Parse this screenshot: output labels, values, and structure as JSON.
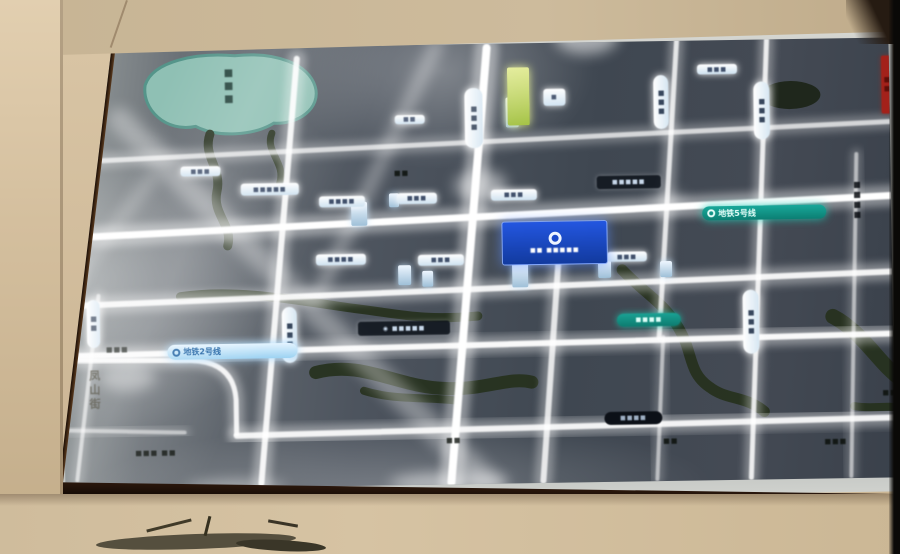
{
  "texts": {
    "metro_line_2": "地铁2号线",
    "metro_line_5": "地铁5号线",
    "street_vertical": "凤山街",
    "lake_label": "■■■",
    "project_logo_text": "■■ ■■■■■"
  },
  "colors": {
    "wall": "#cbb694",
    "frame": "#4a2d15",
    "map_bg": "#454c56",
    "road": "#ffffff",
    "lake": "#8fc0b4",
    "lake_edge": "#55958a",
    "river": "#26311d",
    "trees": "#1c2316",
    "metro2": "#9cd2f2",
    "metro5": "#12998c",
    "project_blue": "#1b49c8",
    "red_marker": "#a3211a"
  },
  "map": {
    "lake_path": "M 86,36 C 94,12 138,4 176,8 C 218,4 250,18 256,40 C 262,62 238,78 214,76 C 194,88 158,90 136,78 C 106,84 82,60 86,36 Z",
    "rivers": [
      {
        "d": "M 150,86 C 142,108 162,120 156,144 C 151,166 172,178 166,198",
        "w": 9
      },
      {
        "d": "M 212,86 C 204,104 226,116 219,136",
        "w": 7
      },
      {
        "d": "M 118,248 C 180,240 245,256 295,263 C 338,269 360,276 415,272",
        "w": 9
      },
      {
        "d": "M 252,326 C 300,314 332,342 382,344 C 424,346 444,333 468,339",
        "w": 13
      },
      {
        "d": "M 300,345 C 330,355 360,352 390,356",
        "w": 8
      },
      {
        "d": "M 560,228 C 582,252 602,262 616,288 C 630,312 624,332 646,347 C 662,360 682,356 700,372",
        "w": 11
      },
      {
        "d": "M 770,278 C 800,294 818,330 838,342",
        "w": 15
      },
      {
        "d": "M 790,368 C 810,372 826,366 838,372",
        "w": 8
      }
    ],
    "trees": [
      [
        731,
        56,
        30,
        14
      ]
    ],
    "roads": [
      [
        8,
        112,
        830,
        84,
        5,
        0.7
      ],
      [
        0,
        188,
        830,
        158,
        7,
        1
      ],
      [
        0,
        256,
        830,
        234,
        6,
        0.9
      ],
      [
        0,
        306,
        830,
        296,
        6,
        0.95
      ],
      [
        172,
        388,
        830,
        380,
        6,
        0.9
      ],
      [
        2,
        380,
        120,
        384,
        4,
        0.5
      ],
      [
        238,
        12,
        196,
        436,
        6,
        0.9
      ],
      [
        428,
        4,
        386,
        438,
        8,
        1
      ],
      [
        498,
        200,
        478,
        438,
        6,
        0.8
      ],
      [
        618,
        0,
        596,
        296,
        5,
        0.8
      ],
      [
        600,
        296,
        592,
        438,
        4,
        0.55
      ],
      [
        708,
        0,
        686,
        438,
        5,
        0.85
      ],
      [
        796,
        116,
        786,
        438,
        4,
        0.55
      ],
      [
        36,
        246,
        12,
        430,
        4,
        0.6
      ],
      [
        1,
        56,
        1,
        438,
        9,
        0.5
      ]
    ],
    "corner": {
      "d": "M 2,310 L 128,312 Q 170,314 172,352 L 172,388",
      "w": 5,
      "o": 0.9
    },
    "streaks": [
      [
        60,
        70,
        426,
        442,
        24,
        0.35
      ],
      [
        378,
        0,
        254,
        252,
        12,
        0.4
      ],
      [
        92,
        128,
        10,
        232,
        10,
        0.3
      ]
    ],
    "blooms": [
      [
        420,
        142,
        26,
        16,
        0.5
      ],
      [
        528,
        -6,
        32,
        18,
        0.55
      ],
      [
        2,
        206,
        16,
        64,
        0.5
      ],
      [
        64,
        328,
        28,
        14,
        0.4
      ],
      [
        606,
        160,
        18,
        9,
        0.35
      ],
      [
        384,
        438,
        60,
        10,
        0.5
      ],
      [
        170,
        440,
        50,
        8,
        0.4
      ]
    ],
    "buildings": [
      [
        290,
        156,
        16,
        24
      ],
      [
        336,
        220,
        13,
        20
      ],
      [
        360,
        226,
        11,
        16
      ],
      [
        450,
        220,
        16,
        24
      ],
      [
        536,
        218,
        13,
        18
      ],
      [
        446,
        54,
        13,
        30
      ],
      [
        448,
        24,
        22,
        58,
        "#dfe98a",
        "#9fbf3a"
      ],
      [
        328,
        148,
        10,
        14
      ],
      [
        598,
        220,
        12,
        16
      ]
    ],
    "labels": [
      [
        180,
        136,
        58,
        12,
        "glow",
        "■■■■■"
      ],
      [
        258,
        150,
        46,
        11,
        "glow",
        "■■■■"
      ],
      [
        336,
        148,
        40,
        11,
        "glow",
        "■■■"
      ],
      [
        430,
        146,
        46,
        11,
        "glow",
        "■■■"
      ],
      [
        120,
        118,
        40,
        10,
        "glow",
        "■■■"
      ],
      [
        254,
        208,
        50,
        11,
        "glow",
        "■■■■"
      ],
      [
        356,
        210,
        46,
        11,
        "glow",
        "■■■"
      ],
      [
        452,
        208,
        50,
        11,
        "glow",
        "■■■■"
      ],
      [
        545,
        210,
        40,
        10,
        "glow",
        "■■■"
      ],
      [
        335,
        70,
        30,
        9,
        "glow",
        "■■"
      ],
      [
        484,
        46,
        22,
        17,
        "glow",
        "■"
      ],
      [
        638,
        24,
        40,
        10,
        "glow",
        "■■■"
      ],
      [
        536,
        134,
        64,
        13,
        "dark",
        "■■■■■"
      ],
      [
        295,
        276,
        92,
        14,
        "dark",
        "◉ ■■■■■"
      ],
      [
        33,
        295,
        42,
        10,
        "dashes",
        "■■■"
      ],
      [
        328,
        124,
        26,
        8,
        "dashes",
        "■■"
      ],
      [
        58,
        398,
        66,
        12,
        "dashes",
        "■■■ ■■"
      ],
      [
        368,
        392,
        42,
        9,
        "dashes",
        "■■"
      ],
      [
        588,
        396,
        36,
        9,
        "dashes",
        "■■"
      ],
      [
        746,
        398,
        50,
        10,
        "dashes",
        "■■■"
      ],
      [
        806,
        350,
        40,
        10,
        "dashes",
        "■■"
      ],
      [
        540,
        370,
        58,
        13,
        "blackcap",
        "■■■■"
      ],
      [
        554,
        272,
        64,
        13,
        "tealcap",
        "■■■■"
      ],
      [
        405,
        44,
        18,
        60,
        "vcap",
        "■■■"
      ],
      [
        594,
        34,
        15,
        54,
        "vcap",
        "■■■"
      ],
      [
        694,
        42,
        16,
        58,
        "vcap",
        "■■■"
      ],
      [
        219,
        260,
        15,
        56,
        "vcap",
        "■■■"
      ],
      [
        24,
        250,
        13,
        48,
        "vcap",
        "■■"
      ],
      [
        680,
        250,
        16,
        64,
        "vcap",
        "■■■"
      ],
      [
        788,
        122,
        15,
        80,
        "vdark",
        "■■■■"
      ],
      [
        822,
        18,
        11,
        58,
        "vred",
        "■■"
      ]
    ],
    "metro2_pos": {
      "x": 104,
      "y": 296,
      "w": 120,
      "h": 15
    },
    "metro5_pos": {
      "x": 641,
      "y": 166,
      "w": 114,
      "h": 14
    },
    "project_pos": {
      "x": 440,
      "y": 178,
      "w": 104,
      "h": 42
    },
    "street_pos": {
      "x": 22,
      "y": 320
    },
    "lake_label_pos": {
      "x": 164,
      "y": 20
    }
  }
}
